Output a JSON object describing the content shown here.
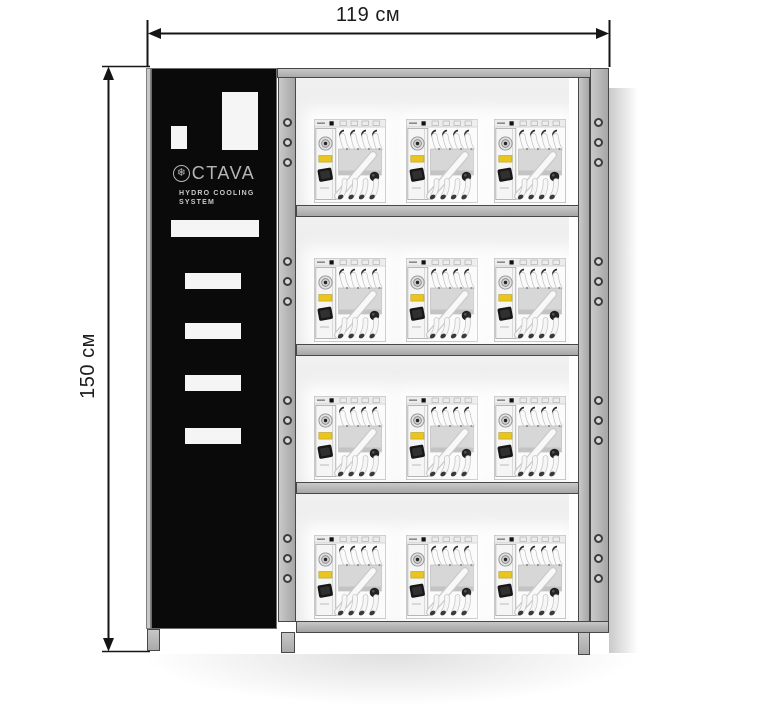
{
  "diagram": {
    "width_label": "119 см",
    "height_label": "150 см"
  },
  "panel": {
    "brand": "CTAVA",
    "brand_icon": "snowflake-ring",
    "subtitle_line1": "HYDRO COOLING",
    "subtitle_line2": "SYSTEM"
  },
  "rack": {
    "shelf_count": 4,
    "units_per_shelf": 3,
    "total_units": 12,
    "holes_per_group": 3
  },
  "colors": {
    "frame_gray": "#b6b6b6",
    "frame_border": "#474747",
    "panel_black": "#0a0a0a",
    "logo_gray": "#b5b5b5",
    "interior_gray": "#ebebeb",
    "unit_accent_yellow": "#eac51e",
    "dimension_ink": "#151515"
  }
}
